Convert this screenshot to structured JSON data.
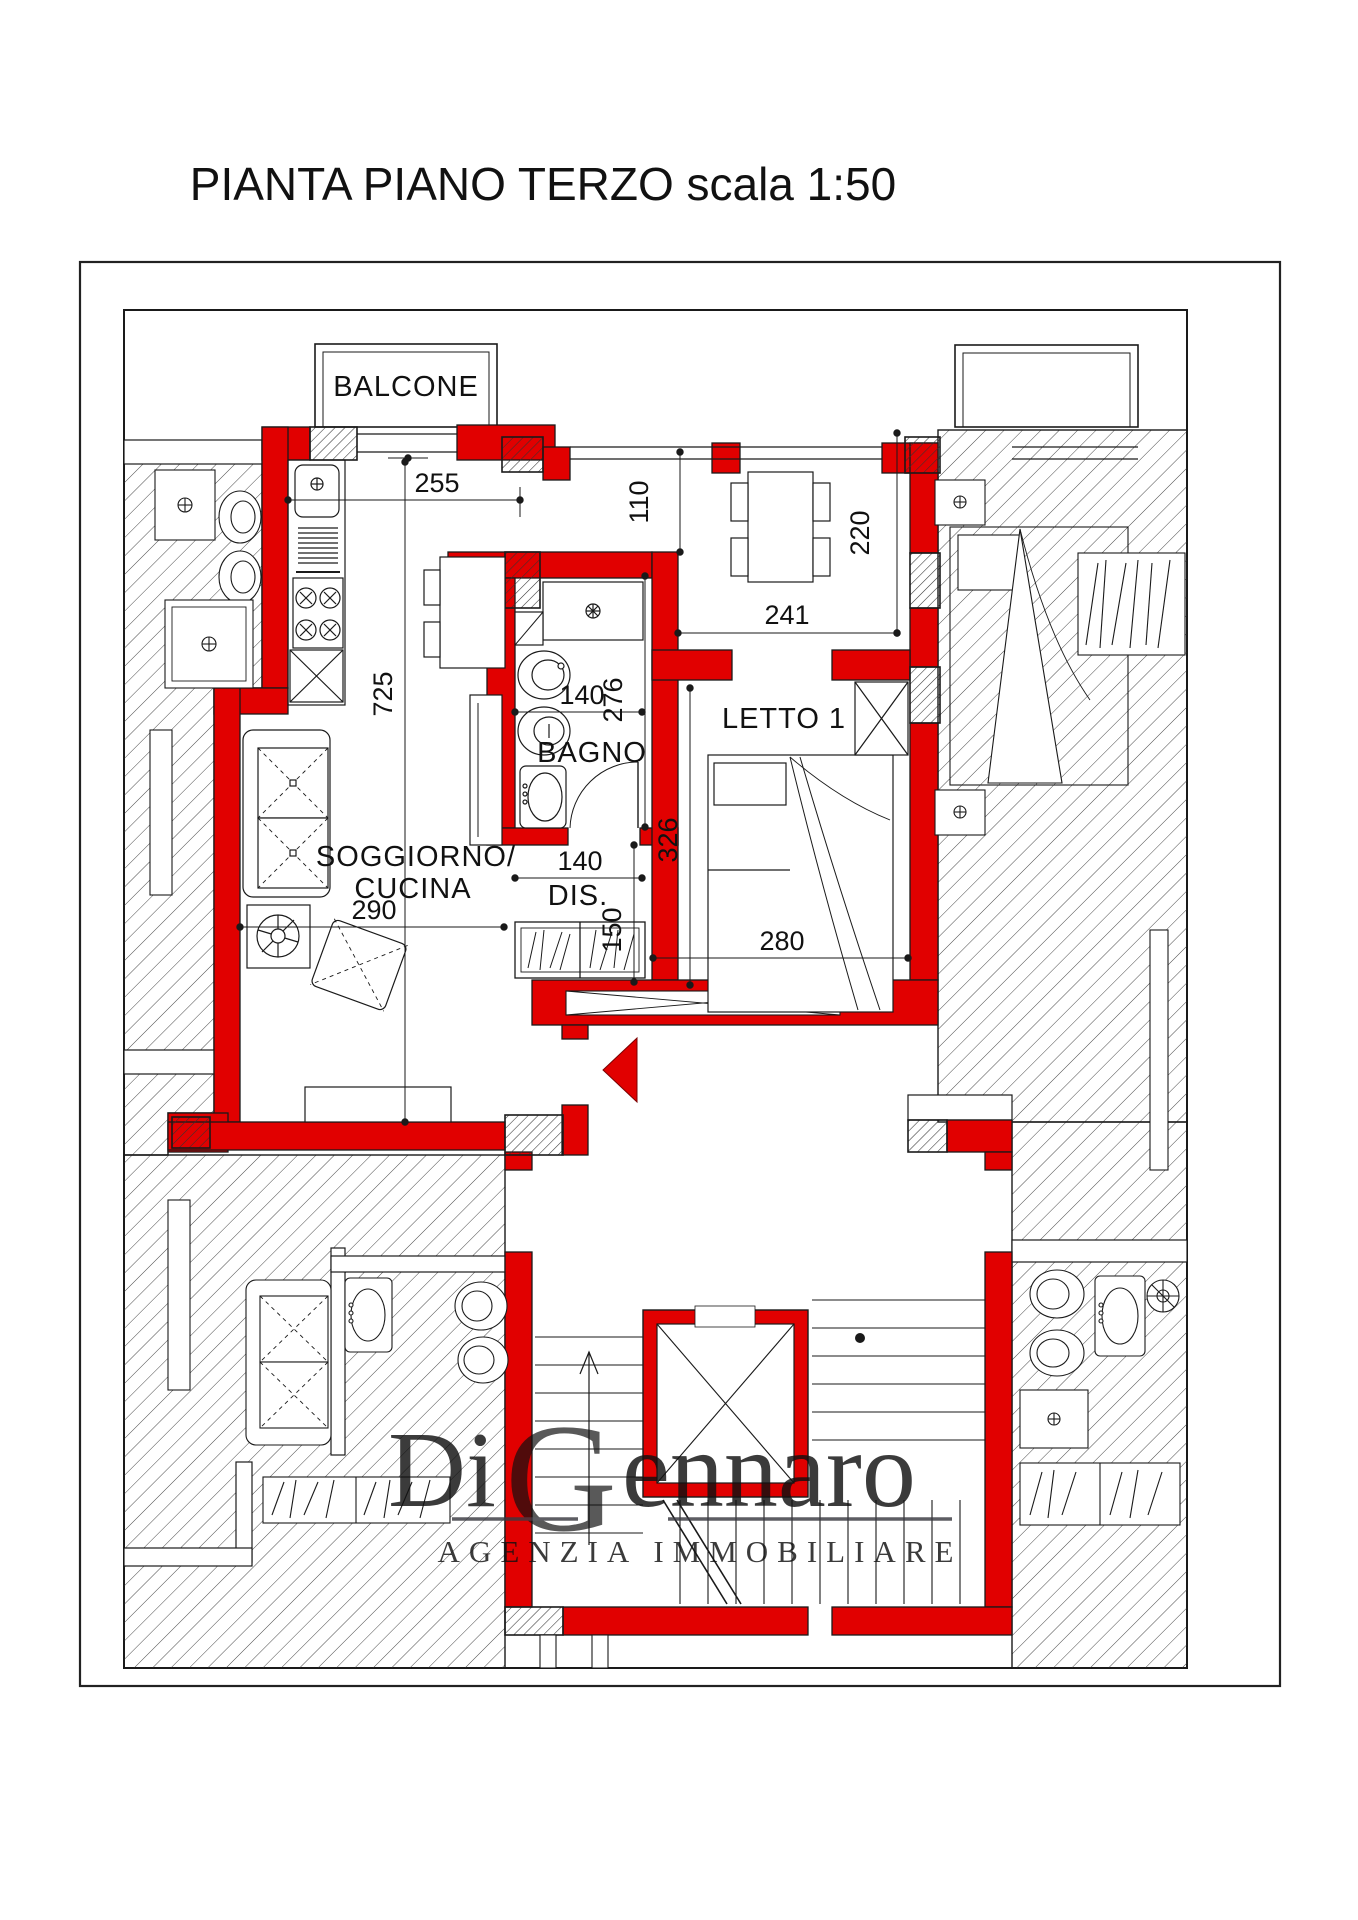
{
  "title": "PIANTA PIANO TERZO scala 1:50",
  "rooms": {
    "balcone": "BALCONE",
    "bagno": "BAGNO",
    "soggiorno_line1": "SOGGIORNO/",
    "soggiorno_line2": "CUCINA",
    "disimpegno": "DIS.",
    "letto1": "LETTO 1"
  },
  "dimensions_cm": {
    "kitchen_front_width": "255",
    "passage_width": "110",
    "dining_width": "241",
    "dining_depth": "220",
    "living_length": "725",
    "bagno_width": "140",
    "bagno_depth": "276",
    "letto_depth": "326",
    "dis_width": "140",
    "dis_depth": "150",
    "soggiorno_width": "290",
    "letto_width": "280"
  },
  "watermark": {
    "brand_part1": "Di",
    "brand_part2": "G",
    "brand_part3": "ennaro",
    "tagline": "AGENZIA IMMOBILIARE"
  },
  "colors": {
    "wall_red": "#e10000",
    "line": "#1a1a1a",
    "hatch": "#4a4a4a",
    "watermark_gray": "#3a3a42",
    "watermark_blue": "#7d88c4"
  }
}
